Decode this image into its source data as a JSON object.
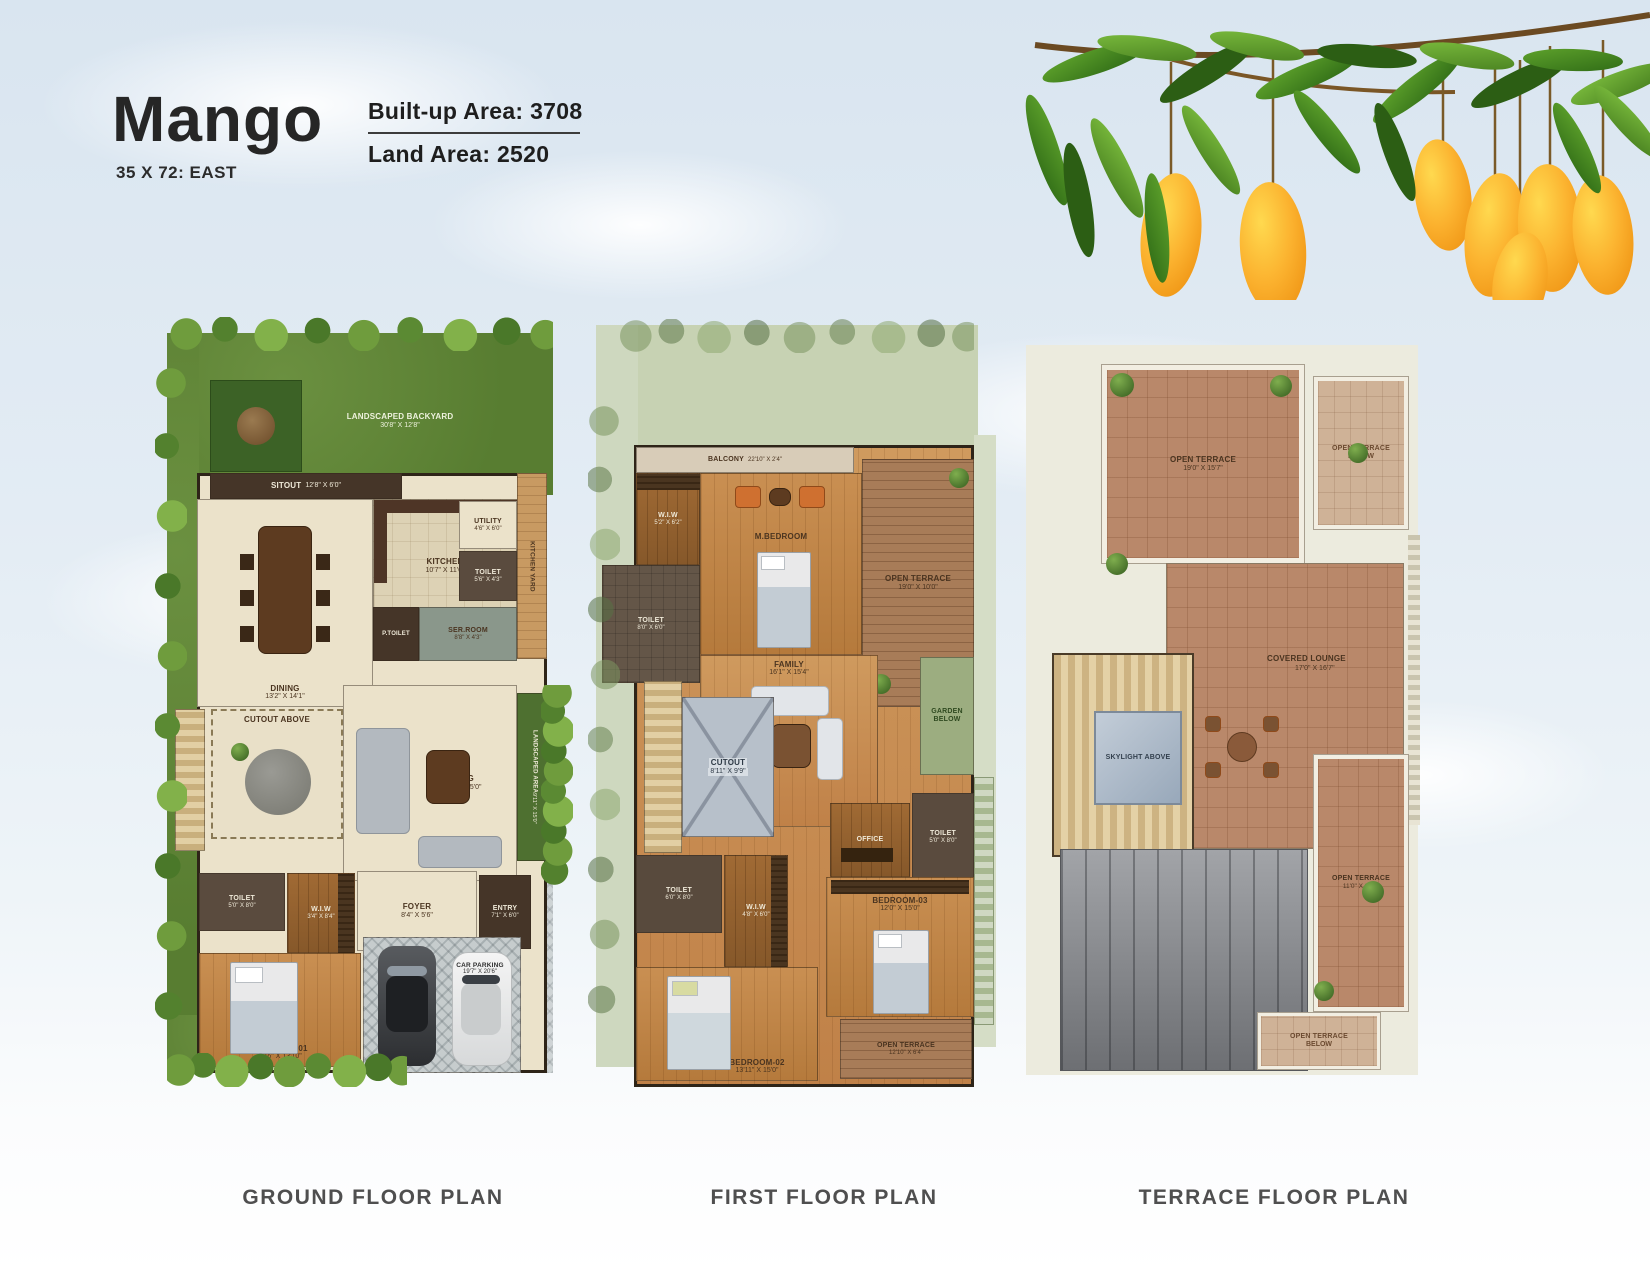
{
  "header": {
    "title": "Mango",
    "subtitle": "35 X 72: EAST",
    "builtup_area": "Built-up Area: 3708",
    "land_area": "Land Area: 2520"
  },
  "captions": {
    "ground": "GROUND FLOOR PLAN",
    "first": "FIRST FLOOR PLAN",
    "terrace": "TERRACE FLOOR PLAN"
  },
  "colors": {
    "sky": "#d9e5f0",
    "grass_green": "#587d31",
    "wood_floor": "#c08148",
    "terracotta_tile": "#b9886a",
    "mango_yellow": "#fbb12e",
    "leaf_green": "#47941f"
  },
  "ground": {
    "rooms": {
      "backyard": {
        "name": "LANDSCAPED BACKYARD",
        "dims": "30'8\" X 12'8\""
      },
      "sitout": {
        "name": "SITOUT",
        "dims": "12'8\" X 6'0\""
      },
      "dining": {
        "name": "DINING",
        "dims": "13'2\" X 14'1\""
      },
      "kitchen": {
        "name": "KITCHEN",
        "dims": "10'7\" X 11'6\""
      },
      "utility": {
        "name": "UTILITY",
        "dims": "4'6\" X 6'0\""
      },
      "kitchen_yard": {
        "name": "KITCHEN YARD",
        "dims": "3'2\" X 14'1\""
      },
      "toilet_kitchen": {
        "name": "TOILET",
        "dims": "5'6\" X 4'3\""
      },
      "ser_room": {
        "name": "SER.ROOM",
        "dims": "8'8\" X 4'3\""
      },
      "p_toilet": {
        "name": "P.TOILET",
        "dims": ""
      },
      "cutout": {
        "name": "CUTOUT ABOVE",
        "dims": ""
      },
      "living": {
        "name": "LIVING",
        "dims": "25'11\" X 15'0\""
      },
      "landscaped_area": {
        "name": "LANDSCAPED AREA",
        "dims": "9'11\" X 15'0\""
      },
      "toilet_bed": {
        "name": "TOILET",
        "dims": "5'0\" X 8'0\""
      },
      "wiw": {
        "name": "W.I.W",
        "dims": "3'4\" X 8'4\""
      },
      "foyer": {
        "name": "FOYER",
        "dims": "8'4\" X 5'6\""
      },
      "entry": {
        "name": "ENTRY",
        "dims": "7'1\" X 6'0\""
      },
      "bedroom_01": {
        "name": "BEDROOM-01",
        "dims": "12'6\" X 13'10\""
      },
      "car_parking": {
        "name": "CAR PARKING",
        "dims": "19'7\" X 20'6\""
      }
    }
  },
  "first": {
    "rooms": {
      "balcony": {
        "name": "BALCONY",
        "dims": "22'10\" X 2'4\""
      },
      "wiw_master": {
        "name": "W.I.W",
        "dims": "5'2\" X 6'2\""
      },
      "m_bedroom": {
        "name": "M.BEDROOM",
        "dims": "12'6\" X 16'0\""
      },
      "open_terrace_top": {
        "name": "OPEN TERRACE",
        "dims": "19'0\" X 10'0\""
      },
      "toilet_master": {
        "name": "TOILET",
        "dims": "8'0\" X 6'0\""
      },
      "family": {
        "name": "FAMILY",
        "dims": "16'1\" X 15'4\""
      },
      "cutout": {
        "name": "CUTOUT",
        "dims": "8'11\" X 9'9\""
      },
      "garden_below": {
        "name": "GARDEN BELOW",
        "dims": ""
      },
      "office": {
        "name": "OFFICE",
        "dims": ""
      },
      "toilet_bed03": {
        "name": "TOILET",
        "dims": "5'0\" X 8'0\""
      },
      "toilet_bed02": {
        "name": "TOILET",
        "dims": "6'0\" X 8'0\""
      },
      "wiw_bed02": {
        "name": "W.I.W",
        "dims": "4'8\" X 6'0\""
      },
      "bedroom_02": {
        "name": "BEDROOM-02",
        "dims": "13'11\" X 15'0\""
      },
      "bedroom_03": {
        "name": "BEDROOM-03",
        "dims": "12'0\" X 15'0\""
      },
      "open_terrace_bottom": {
        "name": "OPEN TERRACE",
        "dims": "12'10\" X 6'4\""
      }
    }
  },
  "terrace": {
    "rooms": {
      "open_terrace_main": {
        "name": "OPEN TERRACE",
        "dims": "19'0\" X 15'7\""
      },
      "open_terrace_below_top": {
        "name": "OPEN TERRACE",
        "dims": "BELOW"
      },
      "skylight": {
        "name": "SKYLIGHT ABOVE",
        "dims": ""
      },
      "covered_lounge": {
        "name": "COVERED LOUNGE",
        "dims": "17'0\" X 16'7\""
      },
      "open_terrace_right": {
        "name": "OPEN TERRACE",
        "dims": "11'0\" X 21'1\""
      },
      "open_terrace_below_bottom": {
        "name": "OPEN TERRACE",
        "dims": "BELOW"
      }
    }
  }
}
